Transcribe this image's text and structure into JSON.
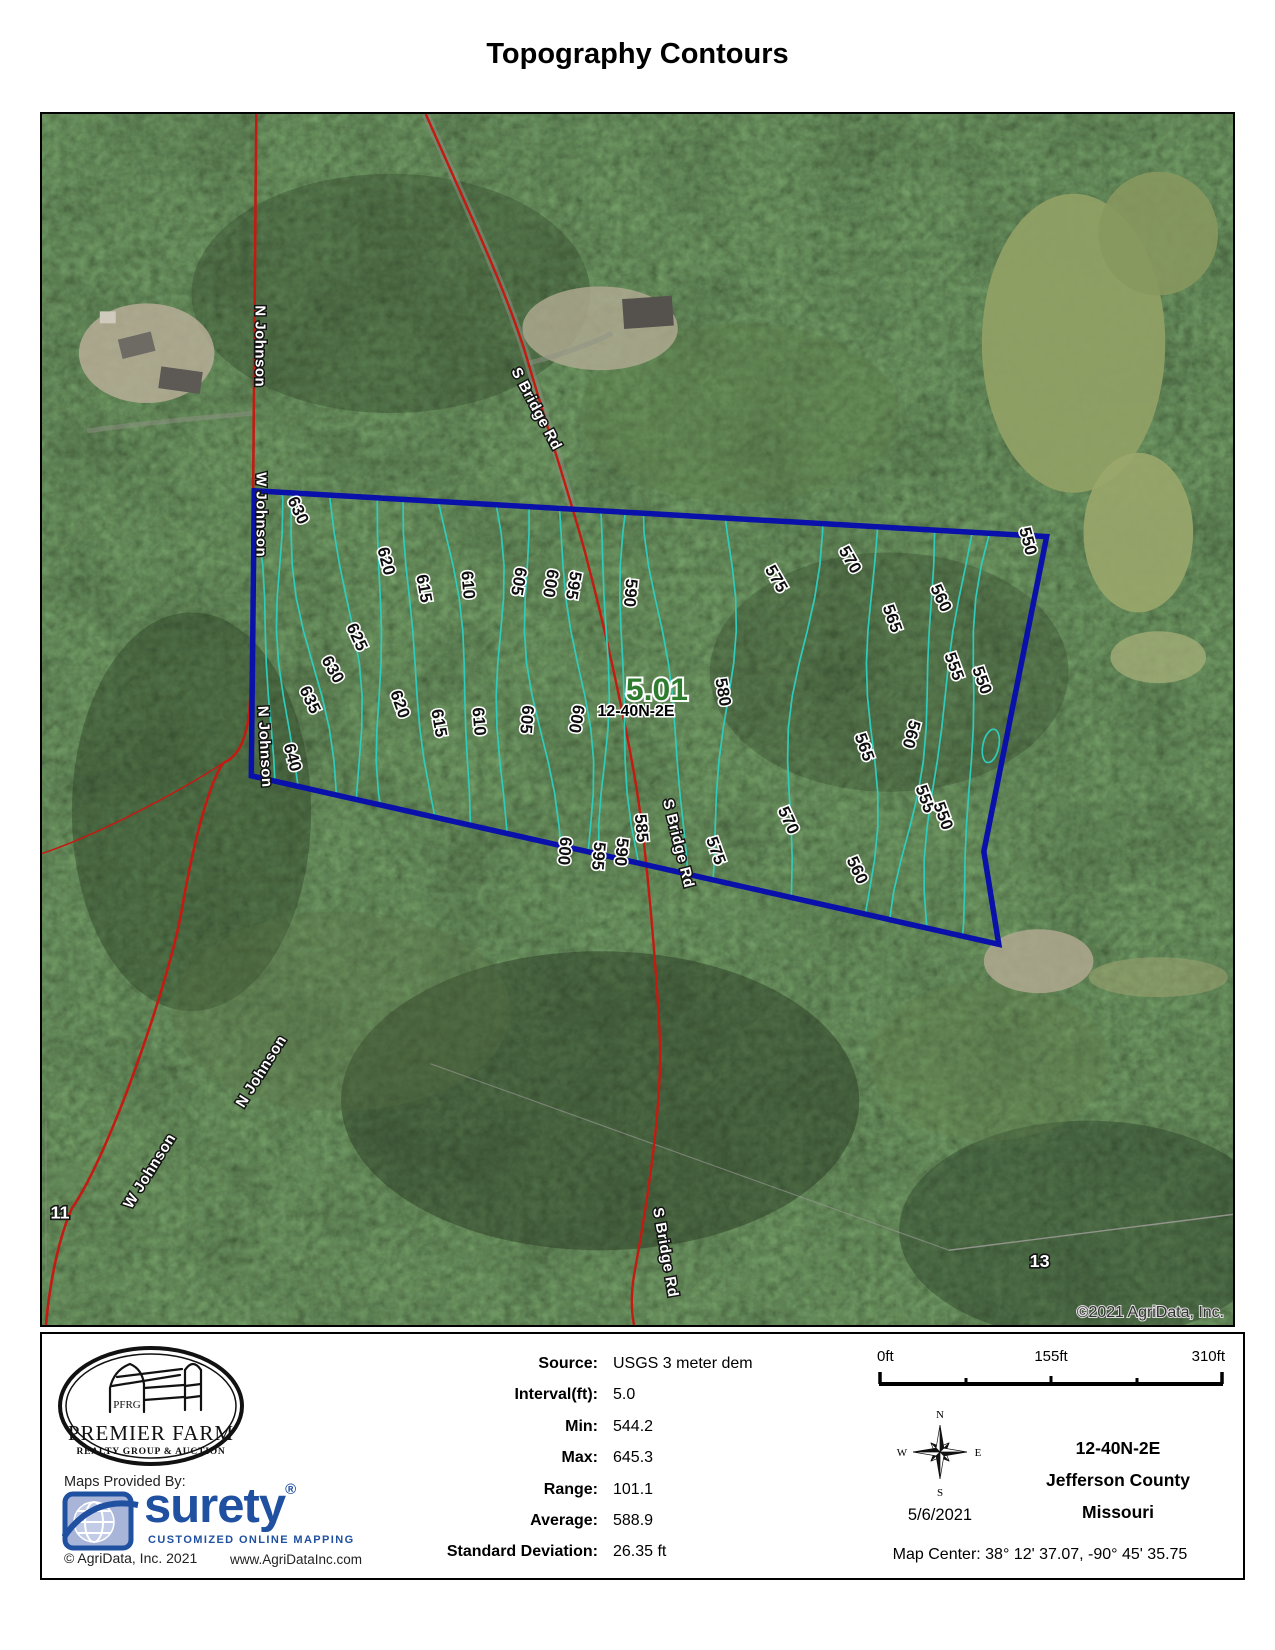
{
  "title": "Topography Contours",
  "map": {
    "parcel_acres_label": "5.01",
    "parcel_section_label": "12-40N-2E",
    "copyright": "©2021 AgriData, Inc.",
    "colors": {
      "contour": "#2fccbc",
      "boundary": "#0a10aa",
      "road": "#c41a12",
      "acres_green": "#2e7d2e"
    },
    "contour_interval_ft": "5.0",
    "contour_elevations_ft": [
      640,
      635,
      630,
      625,
      620,
      615,
      610,
      605,
      600,
      595,
      590,
      585,
      580,
      575,
      570,
      565,
      560,
      555,
      550
    ],
    "contour_labels": [
      "630",
      "620",
      "615",
      "610",
      "605",
      "600",
      "595",
      "590",
      "575",
      "570",
      "565",
      "560",
      "555",
      "550",
      "550",
      "640",
      "635",
      "630",
      "625",
      "620",
      "615",
      "610",
      "605",
      "600",
      "580",
      "600",
      "595",
      "590",
      "585",
      "575",
      "570",
      "565",
      "560",
      "560",
      "555",
      "550"
    ],
    "road_labels": [
      "N Johnson",
      "W Johnson",
      "N Johnson",
      "S Bridge Rd",
      "S Bridge Rd",
      "S Bridge Rd",
      "N Johnson",
      "W Johnson"
    ],
    "section_numbers": [
      "11",
      "13"
    ]
  },
  "footer": {
    "pfrg": {
      "initials": "PFRG",
      "name": "PREMIER FARM",
      "tagline": "REALTY GROUP & AUCTION"
    },
    "maps_provided_by": "Maps Provided By:",
    "surety": {
      "name": "surety",
      "reg": "®",
      "tagline": "CUSTOMIZED ONLINE MAPPING"
    },
    "agridata_copyright": "© AgriData, Inc. 2021",
    "agridata_url": "www.AgriDataInc.com",
    "stats": [
      {
        "label": "Source:",
        "value": "USGS 3 meter dem"
      },
      {
        "label": "Interval(ft):",
        "value": "5.0"
      },
      {
        "label": "Min:",
        "value": "544.2"
      },
      {
        "label": "Max:",
        "value": "645.3"
      },
      {
        "label": "Range:",
        "value": "101.1"
      },
      {
        "label": "Average:",
        "value": "588.9"
      },
      {
        "label": "Standard Deviation:",
        "value": "26.35 ft"
      }
    ],
    "scalebar": {
      "labels": [
        "0ft",
        "155ft",
        "310ft"
      ]
    },
    "compass": {
      "n": "N",
      "e": "E",
      "s": "S",
      "w": "W"
    },
    "date": "5/6/2021",
    "trs": "12-40N-2E",
    "county": "Jefferson County",
    "state": "Missouri",
    "map_center": "Map Center: 38° 12' 37.07,  -90° 45' 35.75"
  }
}
